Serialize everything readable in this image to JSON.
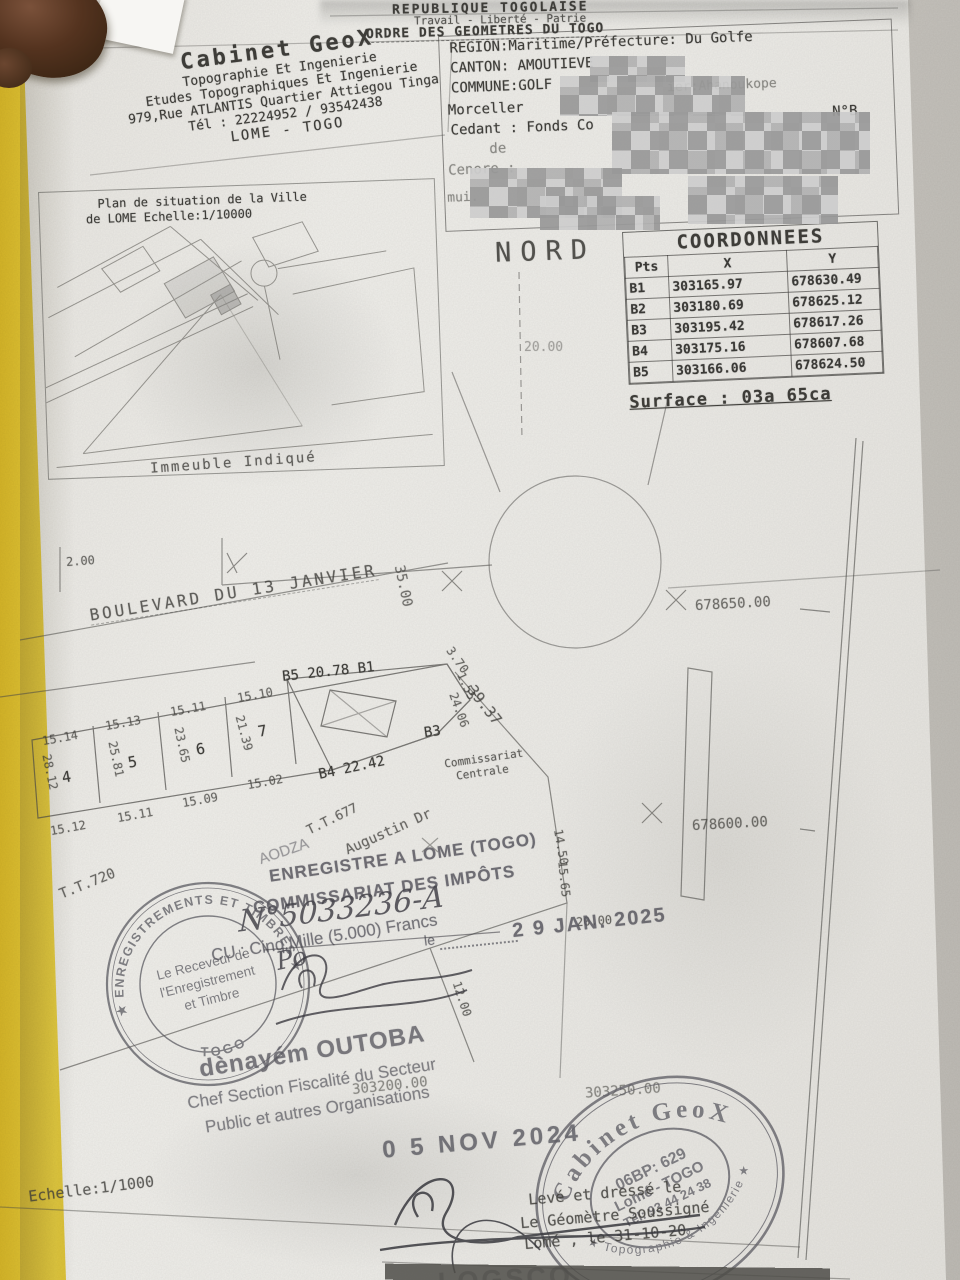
{
  "header": {
    "line1": "REPUBLIQUE TOGOLAISE",
    "line2": "Travail - Liberté - Patrie",
    "line3": "ORDRE DES GEOMETRES DU TOGO"
  },
  "cabinet": {
    "title": "Cabinet GeoX",
    "line1": "Topographie Et Ingenierie",
    "line2": "Etudes Topographiques Et Ingenierie",
    "line3": "979,Rue ATLANTIS Quartier Attiegou Tinga",
    "line4": "Tél : 22224952 / 93542438",
    "line5": "LOME - TOGO"
  },
  "region_box": {
    "region": "REGION:Maritime/Préfecture: Du Golfe",
    "canton": "CANTON: AMOUTIEVE",
    "quartier": "ier:Ahanoukope",
    "commune": "COMMUNE:GOLF",
    "morceller": "Morceller",
    "cedant": "Cedant : Fonds Co",
    "cedant_no": "N°B",
    "de": "de",
    "cenore": "Cenore :",
    "mui": "mui."
  },
  "situation": {
    "title1": "Plan de situation de la Ville",
    "title2": "de LOME Echelle:1/10000",
    "caption": "Immeuble Indiqué"
  },
  "north": {
    "label": "NORD",
    "dim": "20.00"
  },
  "coords": {
    "title": "COORDONNEES",
    "headers": [
      "Pts",
      "X",
      "Y"
    ],
    "rows": [
      [
        "B1",
        "303165.97",
        "678630.49"
      ],
      [
        "B2",
        "303180.69",
        "678625.12"
      ],
      [
        "B3",
        "303195.42",
        "678617.26"
      ],
      [
        "B4",
        "303175.16",
        "678607.68"
      ],
      [
        "B5",
        "303166.06",
        "678624.50"
      ]
    ],
    "surface": "Surface : 03a 65ca"
  },
  "plan": {
    "boulevard": "BOULEVARD DU 13 JANVIER",
    "dim_left": "2.00",
    "dim_35": "35.00",
    "grid_y_top": "678650.00",
    "grid_y_bottom": "678600.00",
    "grid_x_left": "303200.00",
    "grid_x_right": "303250.00",
    "lots": [
      "4",
      "5",
      "6",
      "7"
    ],
    "top_dims": [
      "15.14",
      "15.13",
      "15.11",
      "15.10"
    ],
    "bottom_dims": [
      "15.12",
      "15.11",
      "15.09",
      "15.02"
    ],
    "side_dims": [
      "28.12",
      "25.81",
      "23.65",
      "21.39"
    ],
    "b5_edge": "B5 20.78 B1",
    "b4_edge": "B4 22.42",
    "b3": "B3",
    "d370": "3.70",
    "d155": "1.55",
    "d2406": "24.06",
    "d3937": "39.37",
    "d1450": "14.50",
    "d1565": "15.65",
    "d2000": "20.00",
    "d1200": "12.00",
    "commissariat1": "Commissariat",
    "commissariat2": "Centrale",
    "tt677": "T.T.677",
    "augustin": "Augustin Dr",
    "aodza": "AODZA",
    "tt720": "T.T.720",
    "echelle": "Echelle:1/1000"
  },
  "registration": {
    "line1": "ENREGISTRE A LOME (TOGO)",
    "line2": "COMMISSARIAT DES IMPÔTS",
    "number": "N°5033236-A",
    "le": "le",
    "date": "2 9 JAN. 2025",
    "fee": "CU : Cinq Mille (5.000) Francs",
    "po": "Po"
  },
  "receveur_stamp": {
    "arc_top": "★ ENREGISTREMENTS ET TIMBRES ★",
    "arc_bottom": "TOGO",
    "inner1": "Le Receveur de",
    "inner2": "l'Enregistrement",
    "inner3": "et Timbre"
  },
  "officer": {
    "name": "dènayém OUTOBA",
    "title1": "Chef Section Fiscalité du Secteur",
    "title2": "Public et autres Organisations",
    "date_stamp": "0 5 NOV 2024"
  },
  "geox_stamp": {
    "arc_top": "Cabinet GeoX",
    "arc_bottom": "★ Topographie & Ingenierie ★",
    "inner1": "06BP: 629",
    "inner2": "Lomé - TOGO",
    "inner3": "Tél: 93 44 24 38"
  },
  "footer": {
    "leve": "Levé et dressé le",
    "geometre": "Le Géomètre Soussigné",
    "lome_date": "Lomé , le 31-10-20",
    "partial": "LOGSCO"
  }
}
